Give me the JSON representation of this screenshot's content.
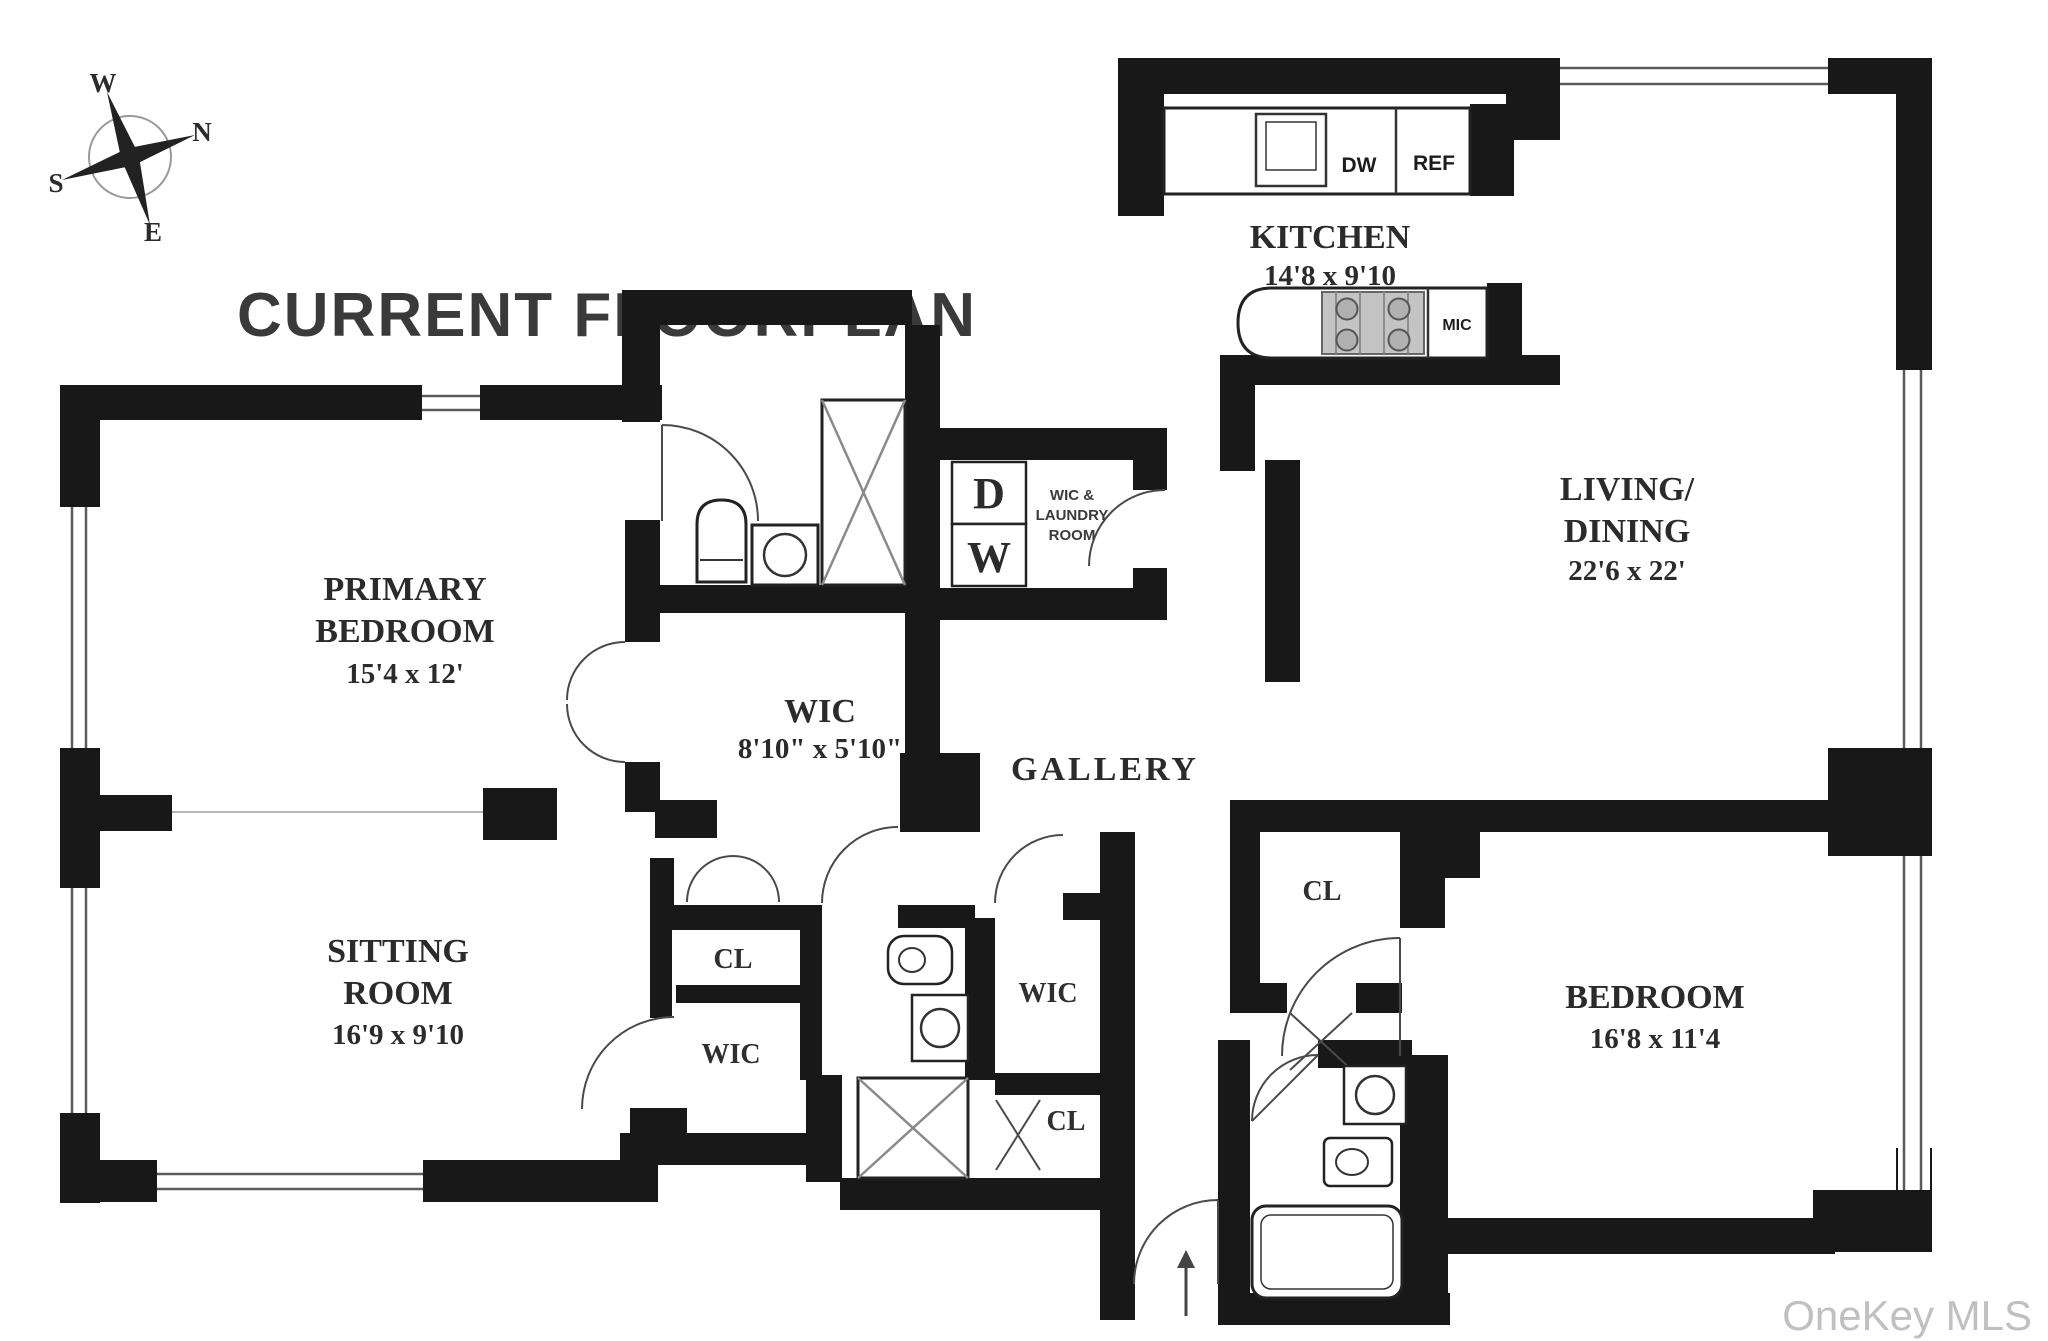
{
  "title": "CURRENT FLOORPLAN",
  "watermark": "OneKey MLS",
  "compass": {
    "west": "W",
    "north": "N",
    "south": "S",
    "east": "E"
  },
  "rooms": {
    "primary_bedroom": {
      "line1": "PRIMARY",
      "line2": "BEDROOM",
      "dims": "15'4 x 12'"
    },
    "sitting_room": {
      "line1": "SITTING",
      "line2": "ROOM",
      "dims": "16'9 x 9'10"
    },
    "kitchen": {
      "line1": "KITCHEN",
      "dims": "14'8 x 9'10"
    },
    "living_dining": {
      "line1": "LIVING/",
      "line2": "DINING",
      "dims": "22'6 x 22'"
    },
    "wic_main": {
      "line1": "WIC",
      "dims": "8'10\" x 5'10\""
    },
    "gallery": {
      "line1": "GALLERY"
    },
    "bedroom": {
      "line1": "BEDROOM",
      "dims": "16'8 x 11'4"
    },
    "laundry": {
      "line1": "WIC &",
      "line2": "LAUNDRY",
      "line3": "ROOM"
    }
  },
  "closets": {
    "cl_sitting": "CL",
    "wic_sitting": "WIC",
    "wic_hall": "WIC",
    "cl_hall": "CL",
    "cl_bedroom": "CL"
  },
  "appliances": {
    "dishwasher": "DW",
    "refrigerator": "REF",
    "microwave": "MIC",
    "dryer": "D",
    "washer": "W"
  }
}
